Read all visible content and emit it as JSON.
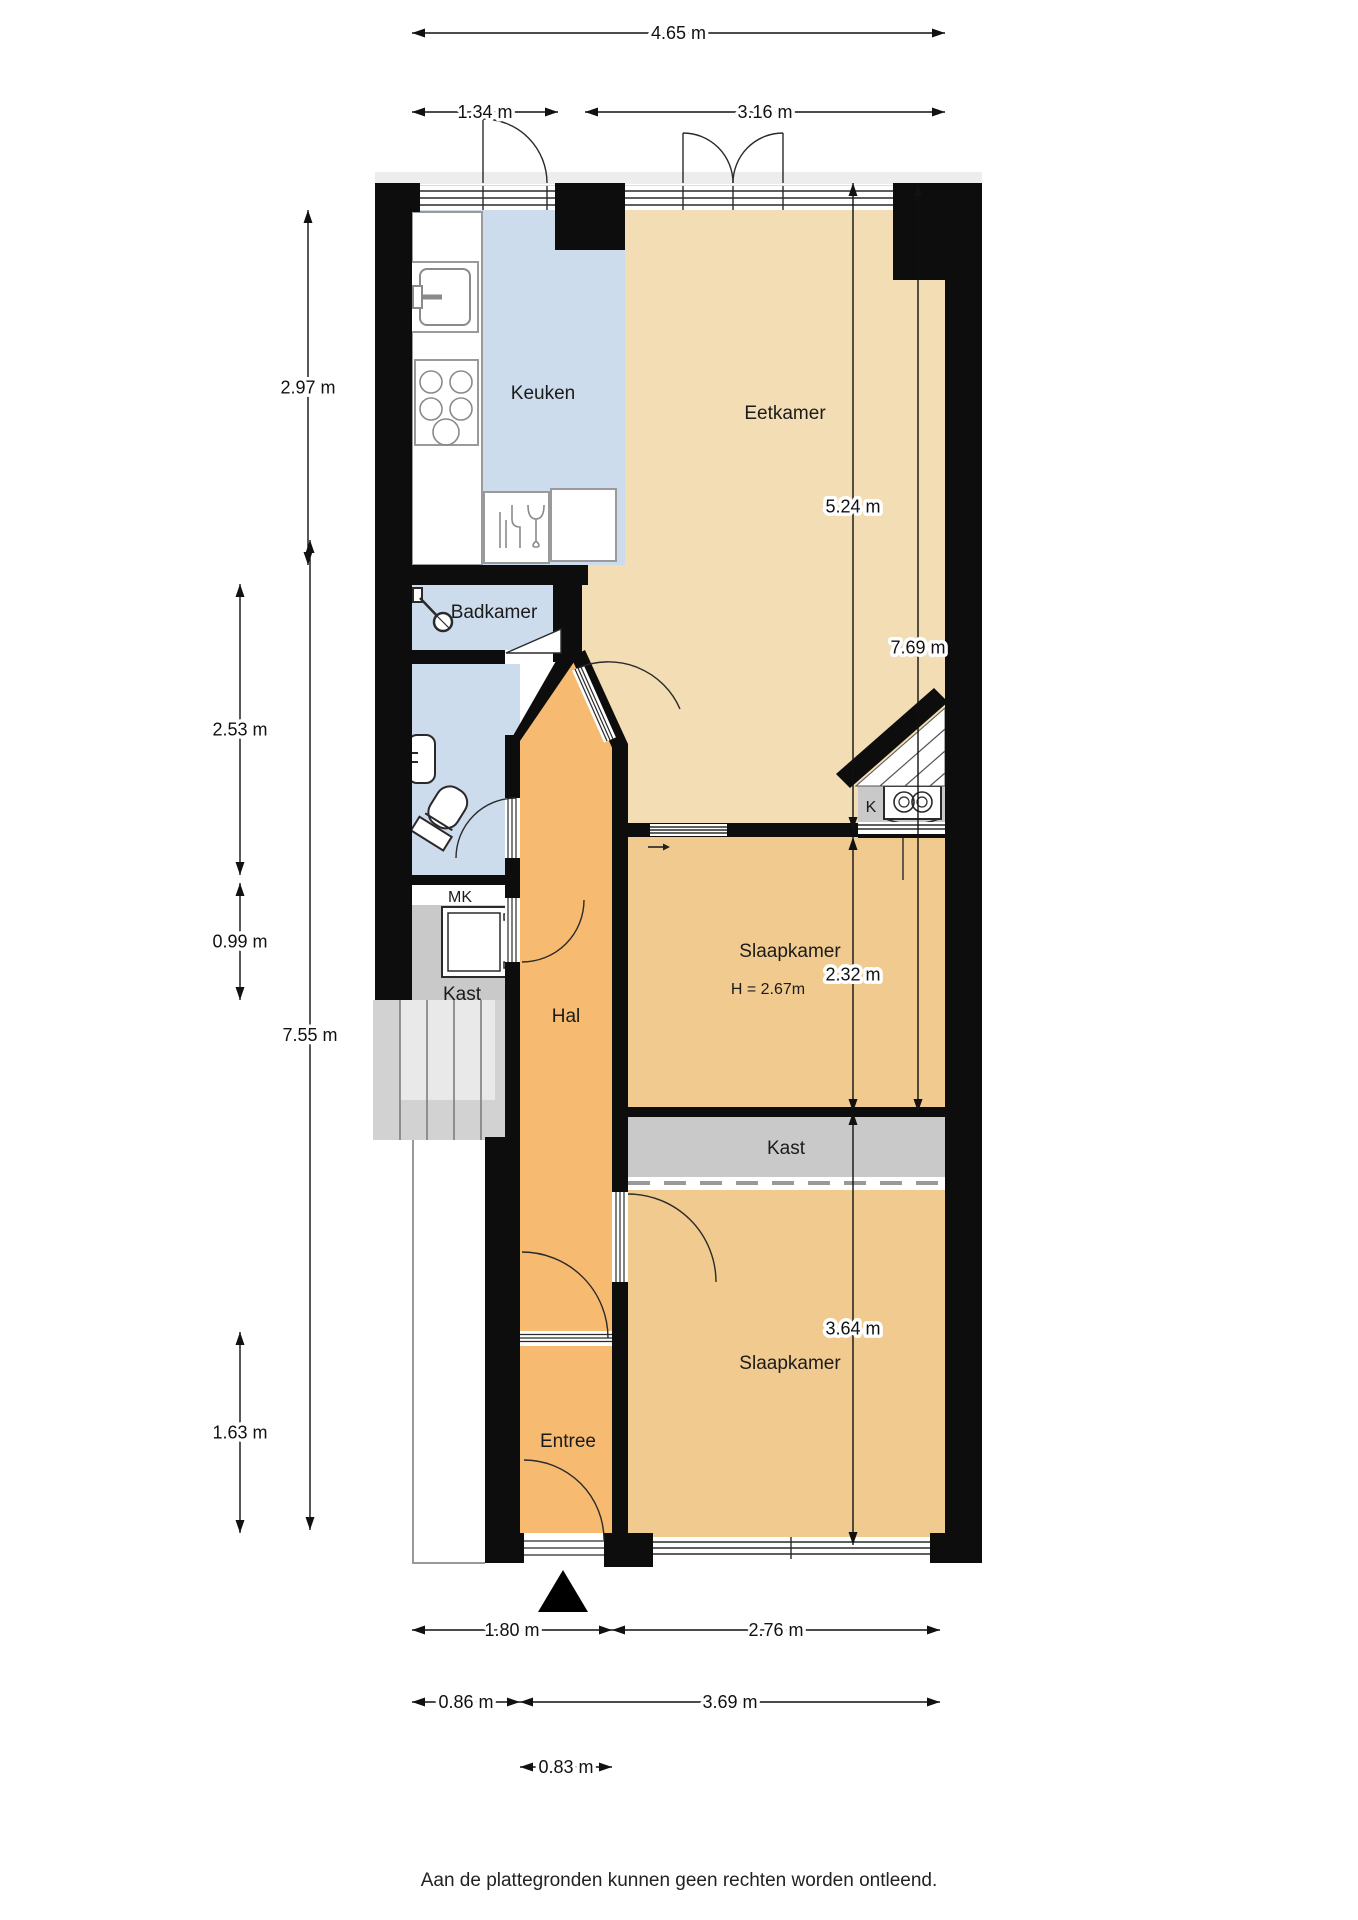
{
  "rooms": {
    "keuken": {
      "label": "Keuken"
    },
    "eetkamer": {
      "label": "Eetkamer"
    },
    "badkamer": {
      "label": "Badkamer"
    },
    "hal": {
      "label": "Hal"
    },
    "slaapkamer1": {
      "label": "Slaapkamer",
      "height_note": "H = 2.67m"
    },
    "slaapkamer2": {
      "label": "Slaapkamer"
    },
    "kast_bedroom": {
      "label": "Kast"
    },
    "kast_hal": {
      "label": "Kast"
    },
    "mk": {
      "label": "MK"
    },
    "k": {
      "label": "K"
    },
    "entree": {
      "label": "Entree"
    }
  },
  "dimensions": {
    "top_total": "4.65 m",
    "top_kitchen": "1.34 m",
    "top_dining": "3.16 m",
    "right_dining": "5.24 m",
    "right_total": "7.69 m",
    "right_bedroom1": "2.32 m",
    "right_bedroom2": "3.64 m",
    "left_kitchen": "2.97 m",
    "left_bathroom": "2.53 m",
    "left_closet": "0.99 m",
    "left_total": "7.55 m",
    "left_entree": "1.63 m",
    "bottom_hall": "1.80 m",
    "bottom_bedroom": "2.76 m",
    "bottom_stairs": "0.86 m",
    "bottom_inner": "3.69 m",
    "bottom_entree": "0.83 m"
  },
  "footer": {
    "disclaimer": "Aan de plattegronden kunnen geen rechten worden ontleend."
  },
  "colors": {
    "wall": "#0d0d0d",
    "dining": "#f2ddb4",
    "bedroom": "#f0ca8e",
    "hall": "#f6ba70",
    "wet": "#cddcec",
    "closet": "#c9c9c9",
    "stairs": "#d2d2d2"
  }
}
